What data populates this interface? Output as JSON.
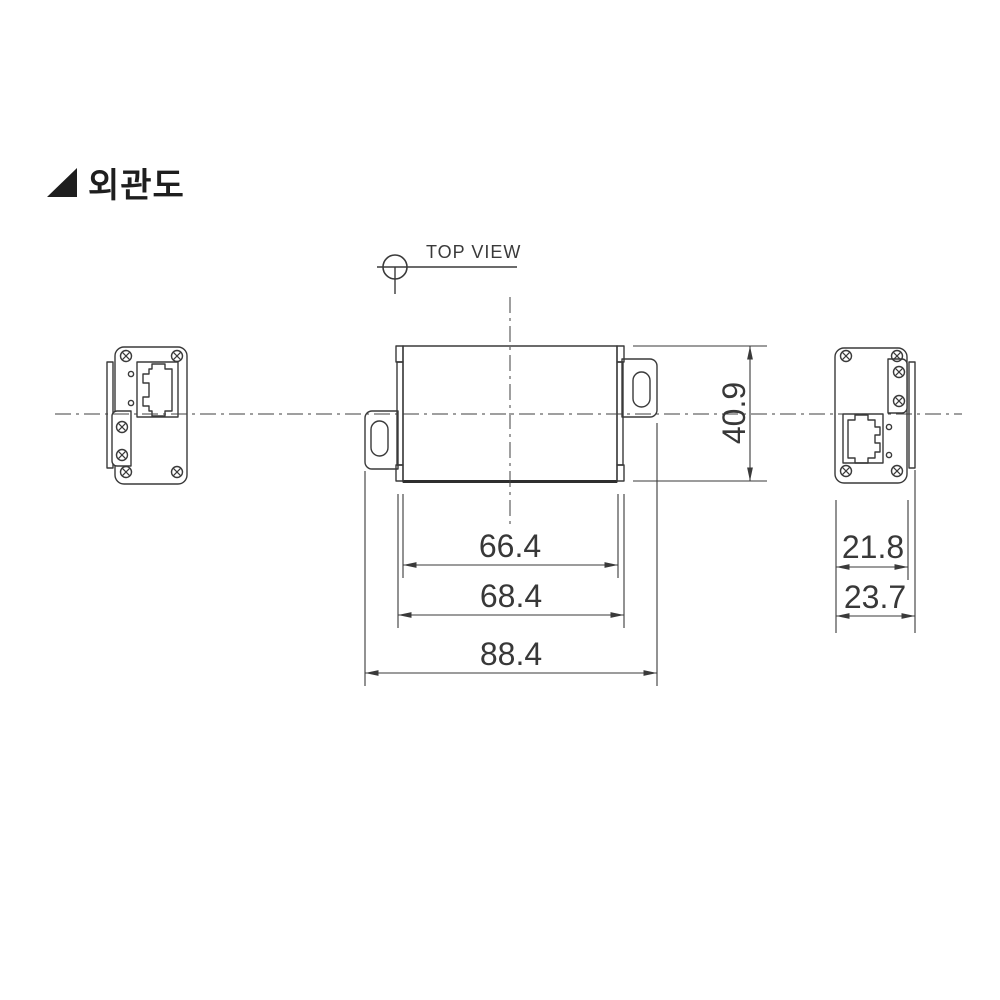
{
  "page": {
    "title": "외관도",
    "background_color": "#ffffff"
  },
  "colors": {
    "line": "#3a3a3a",
    "text": "#2f2f2f"
  },
  "projection_note": {
    "label": "TOP VIEW",
    "symbol": "circle-with-centerlines"
  },
  "icons": {
    "title_marker": "filled-right-triangle",
    "screw": "phillips-screw",
    "port": "rj45-jack",
    "led": "round-hole",
    "slot": "oblong-mounting-slot"
  },
  "dimensions": {
    "body_width": "66.4",
    "plate_width": "68.4",
    "total_width": "88.4",
    "body_height": "40.9",
    "side_face_width": "21.8",
    "side_total_depth": "23.7"
  }
}
